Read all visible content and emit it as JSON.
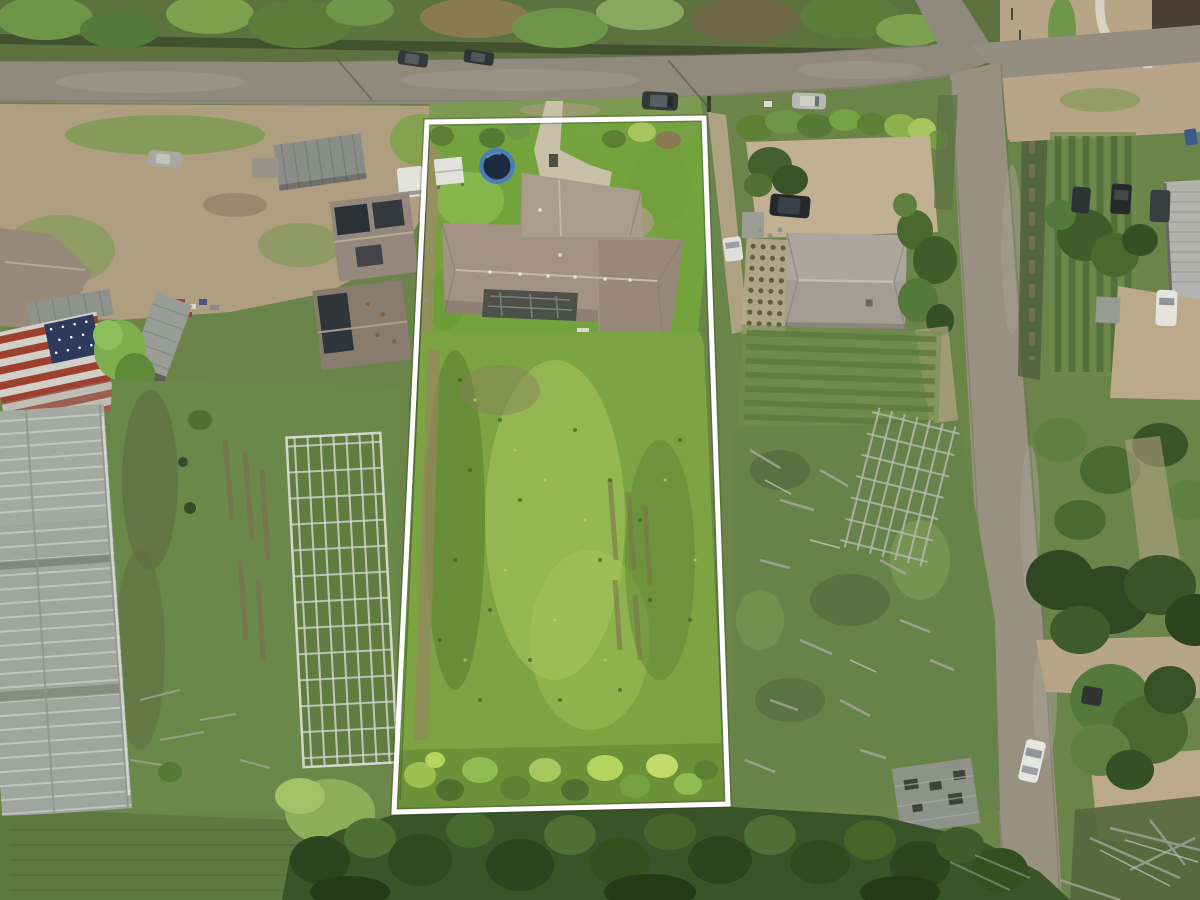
{
  "meta": {
    "type": "aerial-drone-photograph",
    "subject": "vacant residential land parcel outlined in white, single-family house at front, overgrown field behind, rural neighborhood"
  },
  "palette": {
    "scrub": "#6b844a",
    "asphalt": "#8f8a7c",
    "asphalt_light": "#a39c8d",
    "dirt": "#b7a588",
    "dirt_light": "#c8b799",
    "lawn": "#74a33e",
    "lawn_light": "#8fbd52",
    "field": "#7ca443",
    "field_lime": "#a9c75f",
    "field_dark": "#567830",
    "pasture": "#5e7841",
    "canopy": "#3a5429",
    "canopy_dark": "#2b431f",
    "canopy_light": "#4e7034",
    "hedge_lime": "#9dc050",
    "greenhouse": "#a4a9a1",
    "greenhouse_rib": "#c9cdc5",
    "trellis": "#cfd4cc",
    "roof_main": "#a29384",
    "roof_main_light": "#ac9e8e",
    "roof_main_dark": "#97887a",
    "roof_ridge": "#c6b8a5",
    "roof_neighbor": "#a49d93",
    "metal_roof": "#9b9d98",
    "warehouse_roof": "#b2b3ae",
    "flag_red": "#9c4030",
    "flag_white": "#d2cfc6",
    "flag_navy": "#2e3a5c",
    "patio_dark": "#4e5148",
    "trampoline_mat": "#1c2a40",
    "trampoline_ring": "#4a7fb5",
    "car_dark": "#33383b",
    "car_black": "#26292b",
    "car_silver": "#b9b9b4",
    "car_white": "#e6e6e0",
    "shed_gray": "#8e9289",
    "ditch": "#4f5f3a",
    "path_white": "#d8d2c4"
  },
  "scene": {
    "boundary": {
      "name": "property-lot-outline",
      "color": "#ffffff",
      "points": "427,122 704,118 728,804 394,812",
      "stroke_width": "5"
    },
    "objects": [
      "asphalt road across top",
      "cross intersection at top right with side road running south",
      "white-outlined vacant lot",
      "gray shingle-roof house inside lot",
      "backyard trampoline",
      "concrete driveway",
      "greenhouses on left neighbor parcel",
      "barn roof painted as US flag",
      "neighbor house right of lot",
      "parked cars on road and yards",
      "dense tree canopy along bottom"
    ]
  }
}
